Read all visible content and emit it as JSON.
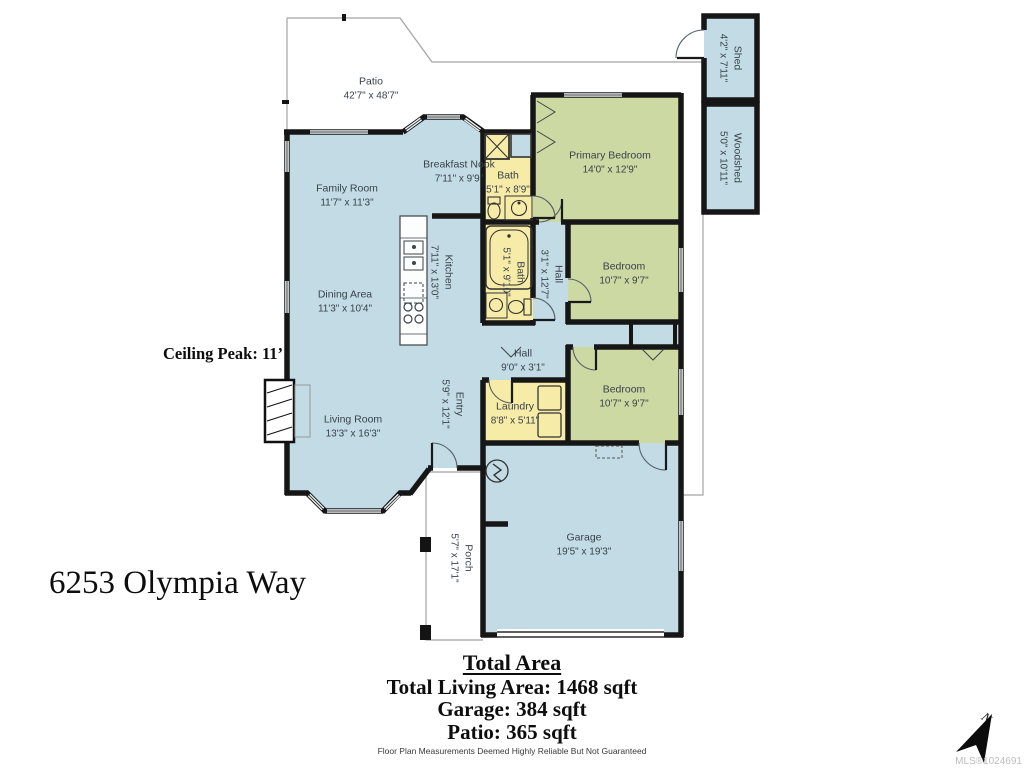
{
  "title": "6253 Olympia Way",
  "annotations": {
    "ceiling_peak": "Ceiling Peak: 11’",
    "north_label": "N",
    "mls": "MLS®1024691"
  },
  "rooms": [
    {
      "name": "Patio",
      "dims": "42'7\" x 48'7\""
    },
    {
      "name": "Shed",
      "dims": "4'2\" x 7'11\""
    },
    {
      "name": "Woodshed",
      "dims": "5'0\" x 10'11\""
    },
    {
      "name": "Family Room",
      "dims": "11'7\" x 11'3\""
    },
    {
      "name": "Breakfast Nook",
      "dims": "7'11\" x 9'9\""
    },
    {
      "name": "Bath",
      "dims": "5'1\" x 8'9\""
    },
    {
      "name": "Primary Bedroom",
      "dims": "14'0\" x 12'9\""
    },
    {
      "name": "Kitchen",
      "dims": "7'11\" x 13'0\""
    },
    {
      "name": "Bath",
      "dims": "5'1\" x 9'10\""
    },
    {
      "name": "Hall",
      "dims": "3'1\" x 12'7\""
    },
    {
      "name": "Bedroom",
      "dims": "10'7\" x 9'7\""
    },
    {
      "name": "Dining Area",
      "dims": "11'3\" x 10'4\""
    },
    {
      "name": "Hall",
      "dims": "9'0\" x 3'1\""
    },
    {
      "name": "Entry",
      "dims": "5'9\" x 12'1\""
    },
    {
      "name": "Laundry",
      "dims": "8'8\" x 5'11\""
    },
    {
      "name": "Bedroom",
      "dims": "10'7\" x 9'7\""
    },
    {
      "name": "Living Room",
      "dims": "13'3\" x 16'3\""
    },
    {
      "name": "Garage",
      "dims": "19'5\" x 19'3\""
    },
    {
      "name": "Porch",
      "dims": "5'7\" x 17'1\""
    }
  ],
  "summary": {
    "heading": "Total Area",
    "line1": "Total Living Area: 1468 sqft",
    "line2": "Garage: 384 sqft",
    "line3": "Patio: 365 sqft",
    "disclaimer": "Floor Plan Measurements Deemed Highly Reliable But Not Guaranteed"
  },
  "colors": {
    "room_blue": "#c3dbe4",
    "room_green": "#ccd9a3",
    "room_yellow": "#f6eba7",
    "wall": "#161616"
  }
}
